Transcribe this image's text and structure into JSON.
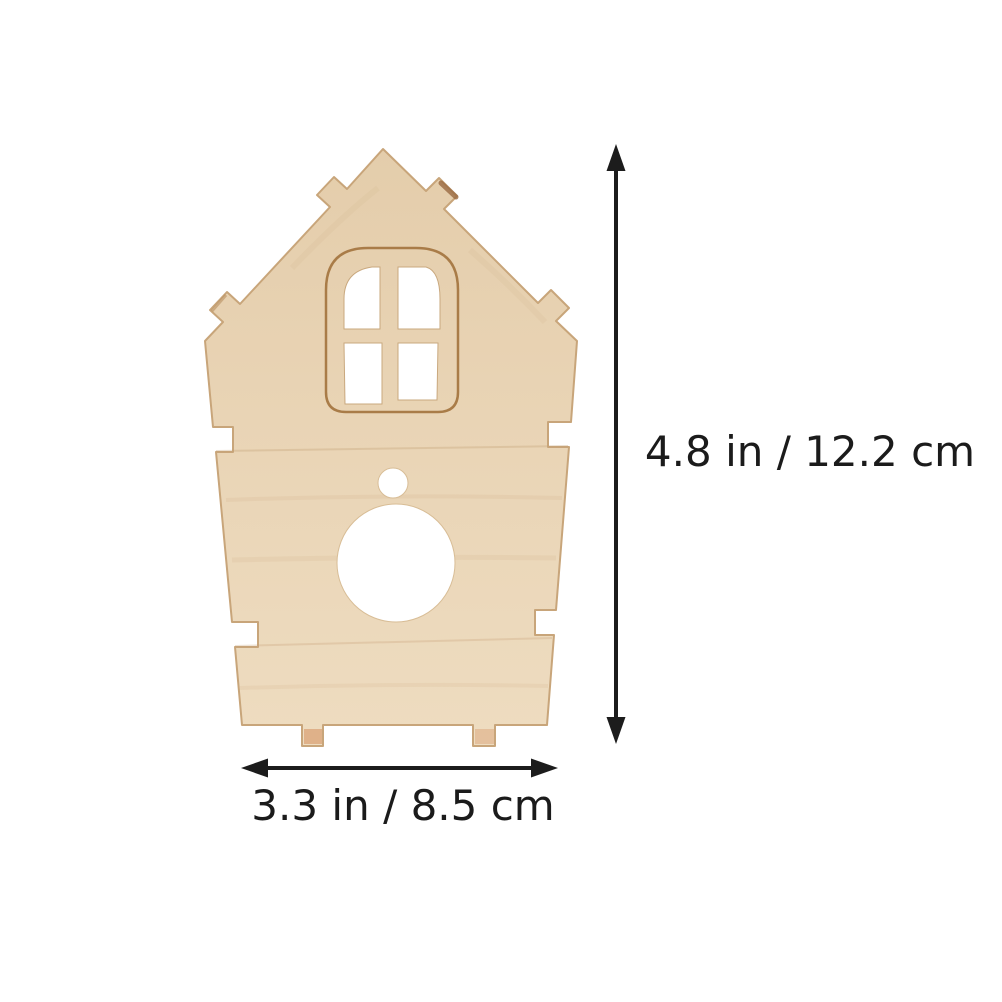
{
  "figure": {
    "description": "Unfinished plywood birdhouse front panel with arched four-pane window cutout, small round hanging hole, large round entrance hole, side assembly notches and bottom tabs"
  },
  "dimensions": {
    "height_label": "4.8 in / 12.2 cm",
    "width_label": "3.3 in / 8.5 cm"
  },
  "colors": {
    "background": "#ffffff",
    "wood_light": "#eedcc0",
    "wood_mid": "#e9d4b5",
    "wood_dark": "#e4cdab",
    "wood_edge": "#c8a57a",
    "engraving": "#a97c48",
    "tab_face": "#dca97f",
    "tab_edge": "#9a6a42",
    "annotation": "#1c1c1c",
    "cutout": "#ffffff"
  }
}
